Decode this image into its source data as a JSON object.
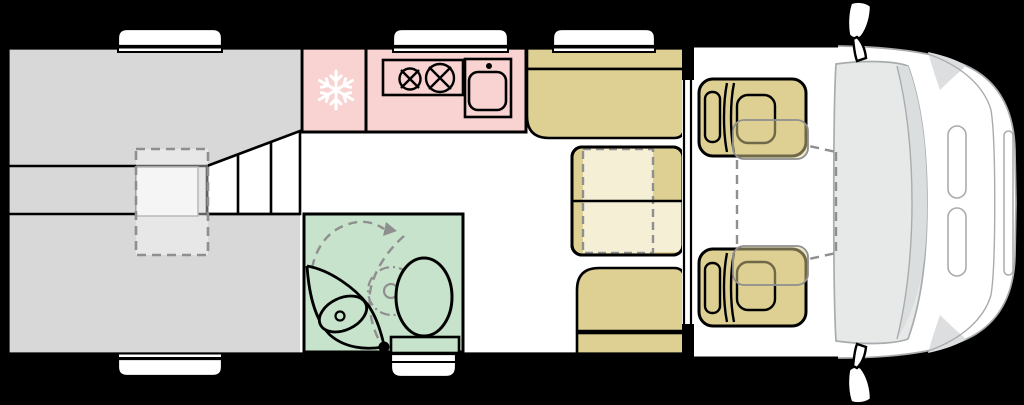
{
  "meta": {
    "kind": "campervan-floorplan",
    "view": "top-down",
    "orientation": "vehicle-front-right"
  },
  "colors": {
    "background": "#000000",
    "outline": "#000000",
    "body": "#ffffff",
    "bed": "#d8d8d8",
    "bed_highlight": "#efefef",
    "kitchen": "#f8d3d1",
    "bathroom": "#c8e3cb",
    "furniture": "#ddd092",
    "table_extension": "#f5efd6",
    "dash_gray": "#8f8f8f",
    "cab_line": "#a9acae",
    "windshield": "#e7e9e9",
    "windshield_dark": "#dbdedf",
    "pillar": "#dcdedf",
    "snowflake": "#ffffff"
  },
  "legend": {
    "rear_bed": "transverse rear bed",
    "bed_extension": "bed extension (dashed)",
    "steps": "bed steps / cabinet",
    "fridge": "fridge (snowflake)",
    "hob": "two-burner hob",
    "sink": "kitchen sink",
    "washbasin": "bathroom washbasin",
    "toilet": "toilet",
    "shower": "swivel shower wall (dashed)",
    "dinette": "dinette bench seats",
    "table": "extendable table",
    "cab_seats": "swivel cab seats",
    "windshield": "windshield",
    "mirrors": "side mirrors",
    "windows": "side windows",
    "entry_step": "entry step"
  }
}
